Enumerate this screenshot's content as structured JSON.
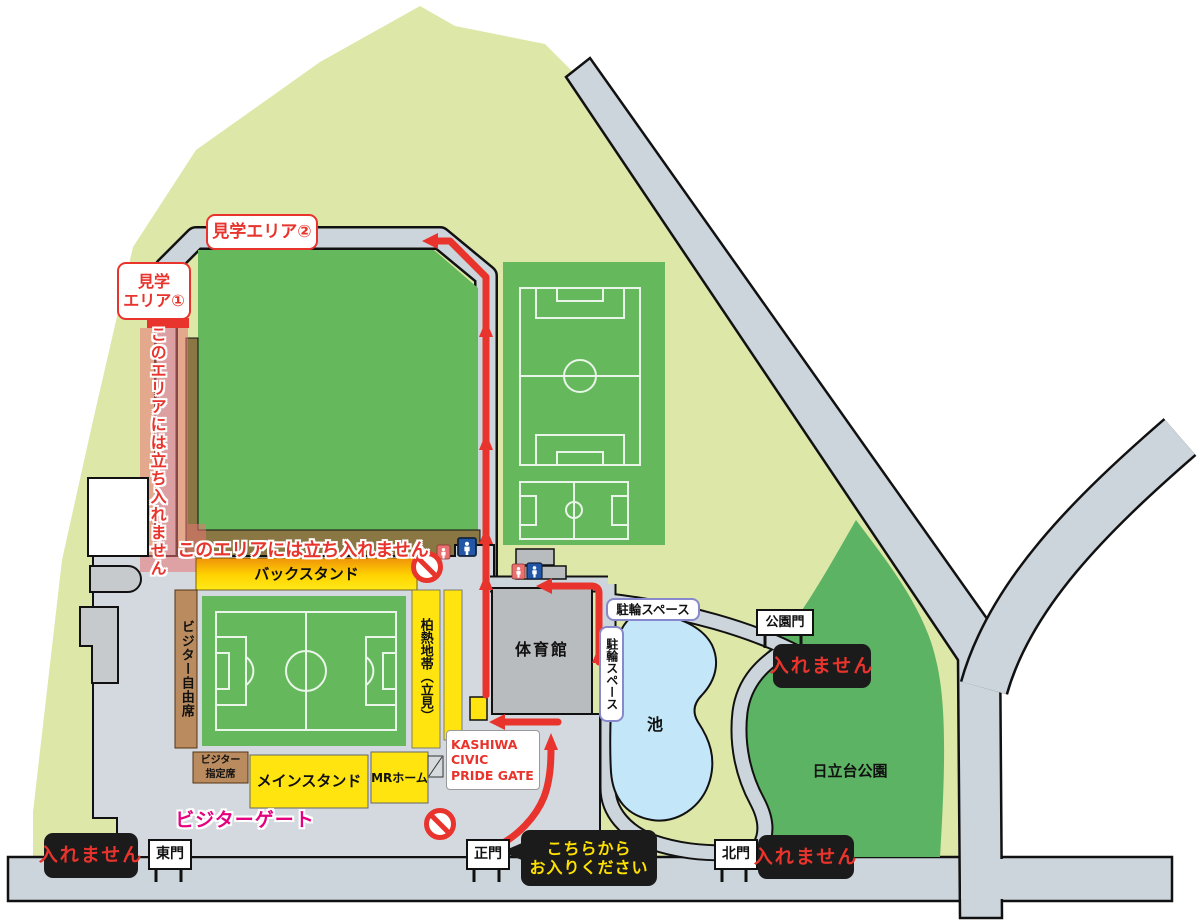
{
  "title": "日立台公園・柏の葉スタジアム周辺案内図",
  "notices": {
    "viewing_area_2": "見学エリア②",
    "viewing_area_1": [
      "見学",
      "エリア①"
    ],
    "no_entry_area": "このエリアには立ち入れません",
    "cannot_enter": "入れません",
    "enter_here": [
      "こちらから",
      "お入りください"
    ]
  },
  "stadium": {
    "back_stand": "バックスタンド",
    "main_stand": "メインスタンド",
    "mr_home": "MRホーム",
    "visitor_free": "ビジター自由席",
    "visitor_reserved": [
      "ビジター",
      "指定席"
    ],
    "hakunetsu_zone": "柏熱地帯（立見）",
    "visitor_gate": "ビジターゲート",
    "kashiwa_gate": [
      "KASHIWA",
      "CIVIC",
      "PRIDE GATE"
    ]
  },
  "facilities": {
    "gymnasium": "体育館",
    "pond": "池",
    "park": "日立台公園",
    "bicycle_space": "駐輪スペース"
  },
  "gates": {
    "east": "東門",
    "main": "正門",
    "north": "北門",
    "park": "公園門"
  },
  "colors": {
    "route_red": "#e8342c",
    "stand_yellow": "#ffe410",
    "pitch_green": "#66b85c",
    "park_green": "#5cb363",
    "site_green": "#dde7a8",
    "pond_blue": "#c3e6f8",
    "road_gray": "#ccd5dc",
    "concourse_gray": "#d3d9de",
    "seat_brown": "#b98b5e",
    "warning_magenta": "#e5007f"
  }
}
